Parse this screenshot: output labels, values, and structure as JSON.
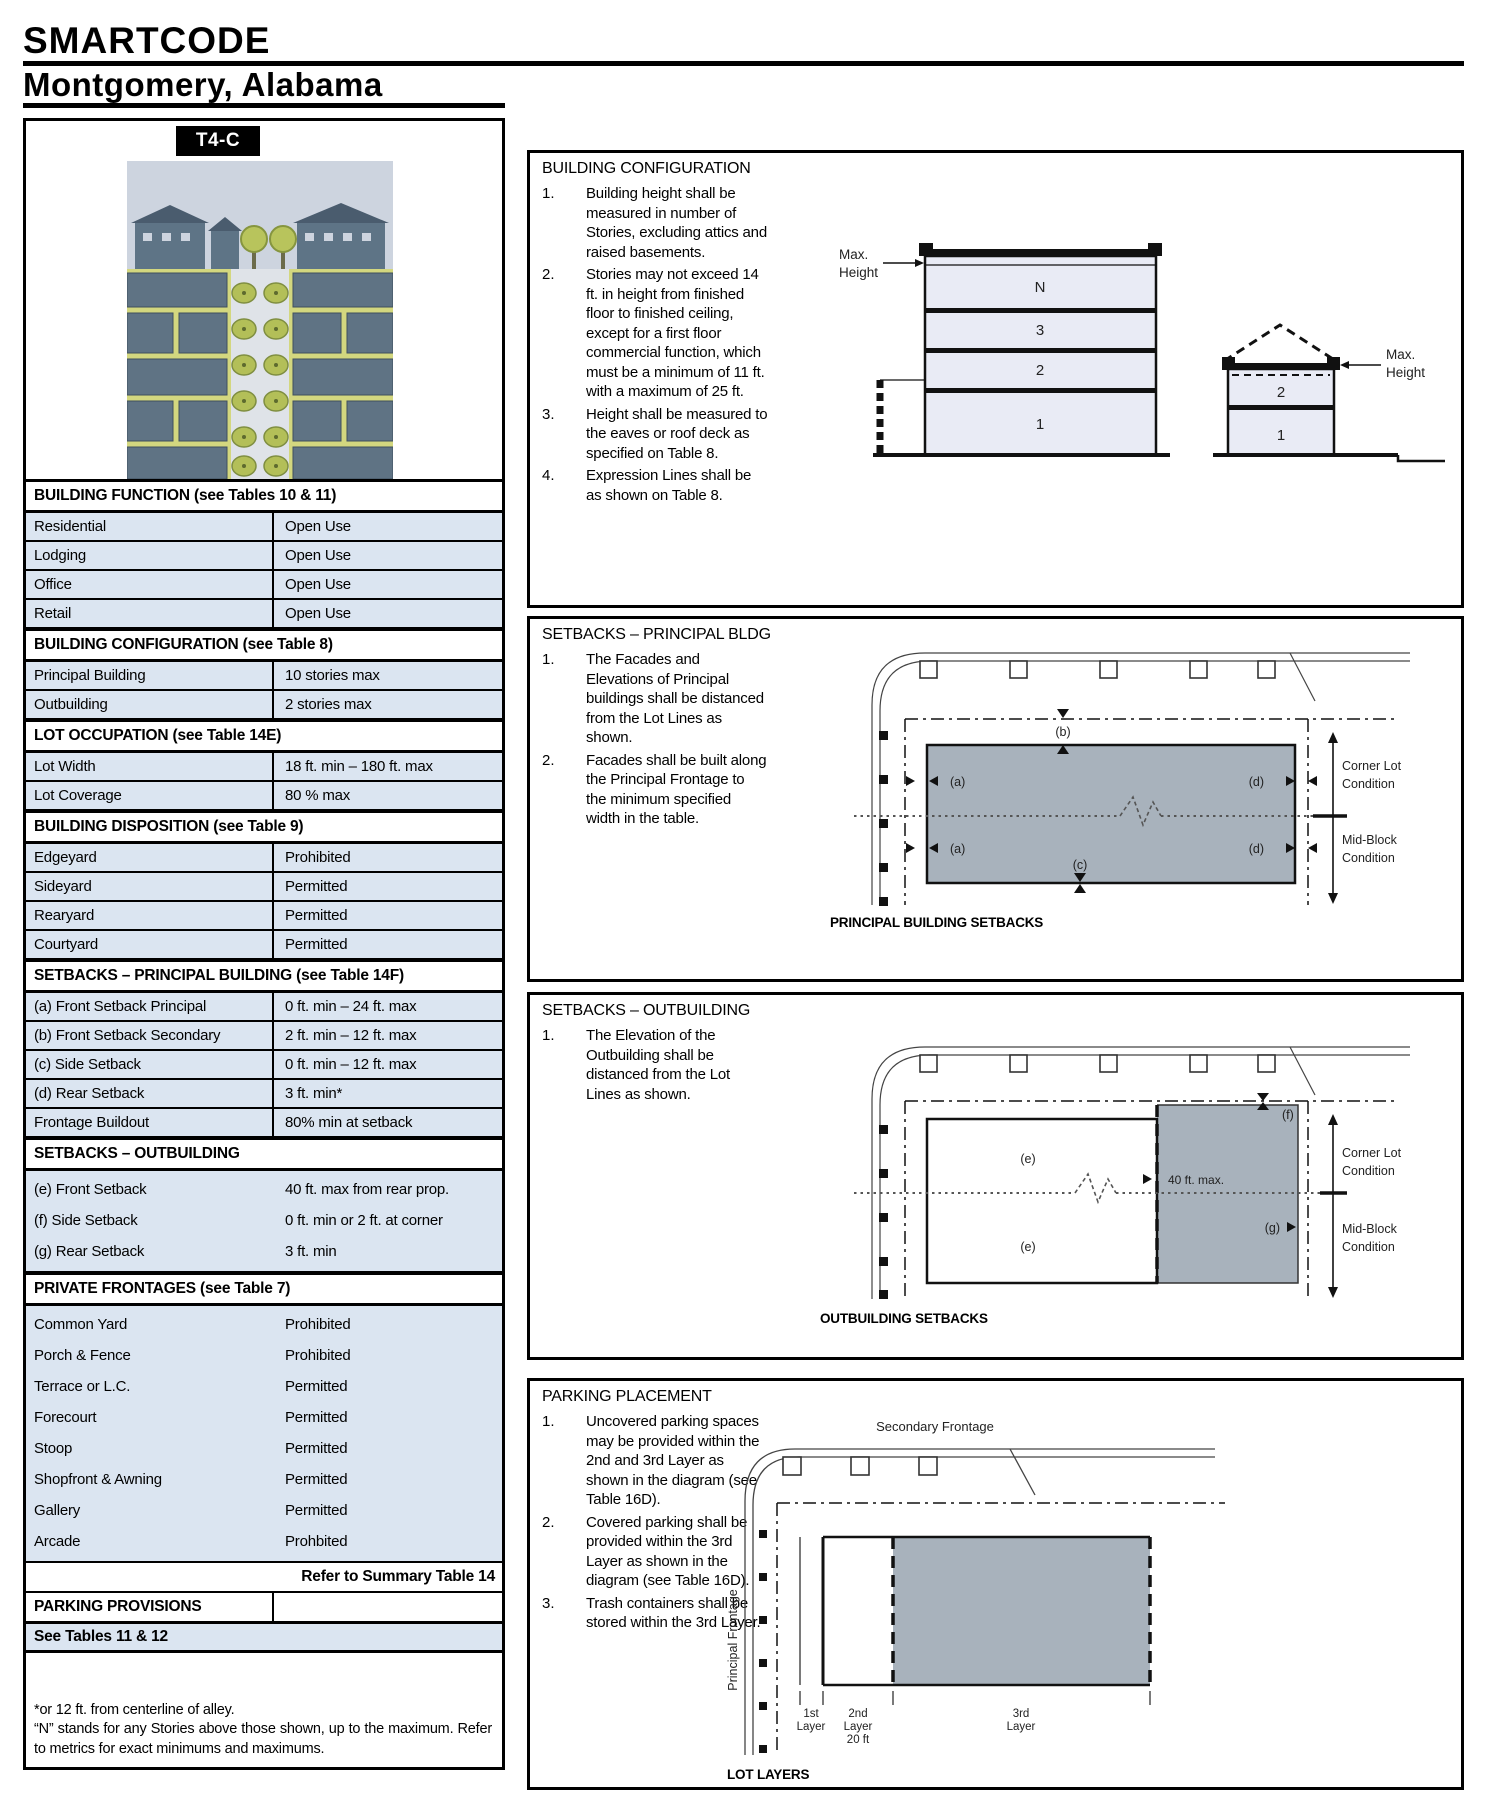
{
  "header": {
    "title": "SMARTCODE",
    "subtitle": "Montgomery, Alabama"
  },
  "zone_card": {
    "tab": "T4-C",
    "sections": [
      {
        "title": "BUILDING FUNCTION (see Tables 10 & 11)",
        "style": "bordered",
        "rows": [
          [
            "Residential",
            "Open Use"
          ],
          [
            "Lodging",
            "Open Use"
          ],
          [
            "Office",
            "Open Use"
          ],
          [
            "Retail",
            "Open Use"
          ]
        ]
      },
      {
        "title": "BUILDING CONFIGURATION (see Table 8)",
        "style": "bordered",
        "rows": [
          [
            "Principal Building",
            "10 stories max"
          ],
          [
            "Outbuilding",
            "2 stories max"
          ]
        ]
      },
      {
        "title": "LOT OCCUPATION (see Table 14E)",
        "style": "bordered",
        "rows": [
          [
            "Lot Width",
            "18 ft. min – 180 ft. max"
          ],
          [
            "Lot Coverage",
            "80 % max"
          ]
        ]
      },
      {
        "title": "BUILDING DISPOSITION (see Table 9)",
        "style": "bordered",
        "rows": [
          [
            "Edgeyard",
            "Prohibited"
          ],
          [
            "Sideyard",
            "Permitted"
          ],
          [
            "Rearyard",
            "Permitted"
          ],
          [
            "Courtyard",
            "Permitted"
          ]
        ]
      },
      {
        "title": "SETBACKS – PRINCIPAL BUILDING (see Table 14F)",
        "style": "bordered",
        "rows": [
          [
            "(a) Front Setback Principal",
            "0 ft. min – 24 ft. max"
          ],
          [
            "(b) Front Setback Secondary",
            "2 ft. min – 12 ft. max"
          ],
          [
            "(c) Side Setback",
            "0 ft. min – 12 ft. max"
          ],
          [
            "(d) Rear Setback",
            "3 ft. min*"
          ],
          [
            "Frontage Buildout",
            "80% min at setback"
          ]
        ]
      },
      {
        "title": "SETBACKS – OUTBUILDING",
        "style": "plain",
        "rows": [
          [
            "(e) Front Setback",
            "40 ft. max from rear prop."
          ],
          [
            "(f) Side Setback",
            "0 ft. min or 2 ft. at corner"
          ],
          [
            "(g) Rear Setback",
            "3 ft. min"
          ]
        ]
      },
      {
        "title": "PRIVATE FRONTAGES (see Table 7)",
        "style": "plain",
        "rows": [
          [
            "Common Yard",
            "Prohibited"
          ],
          [
            "Porch & Fence",
            "Prohibited"
          ],
          [
            "Terrace or L.C.",
            "Permitted"
          ],
          [
            "Forecourt",
            "Permitted"
          ],
          [
            "Stoop",
            "Permitted"
          ],
          [
            "Shopfront & Awning",
            "Permitted"
          ],
          [
            "Gallery",
            "Permitted"
          ],
          [
            "Arcade",
            "Prohbited"
          ]
        ]
      }
    ],
    "refer_note": "Refer to Summary Table 14",
    "parking_provisions": "PARKING PROVISIONS",
    "see_tables": "See Tables 11 & 12",
    "footnote_1": "*or 12 ft. from centerline of alley.",
    "footnote_2": "“N” stands for any Stories above those shown, up to the maximum.  Refer to metrics for exact minimums and maximums."
  },
  "panels": [
    {
      "title": "BUILDING CONFIGURATION",
      "items": [
        "Building height shall be measured in number of Stories, excluding attics and raised basements.",
        "Stories may not exceed 14 ft. in height from finished floor to finished ceiling, except for a first floor commercial function, which must be a minimum of 11 ft. with a maximum of 25 ft.",
        "Height shall be measured to the eaves or roof deck as specified on Table 8.",
        "Expression Lines shall be as shown on Table 8."
      ]
    },
    {
      "title": "SETBACKS – PRINCIPAL BLDG",
      "items": [
        "The Facades and Elevations of Principal buildings shall be distanced from the Lot Lines as shown.",
        "Facades shall be built along the Principal Frontage to the minimum specified width in the table."
      ]
    },
    {
      "title": "SETBACKS – OUTBUILDING",
      "items": [
        "The Elevation of the Outbuilding shall be distanced from the Lot Lines as shown."
      ]
    },
    {
      "title": "PARKING PLACEMENT",
      "items": [
        "Uncovered parking spaces may be provided within the 2nd and 3rd Layer as shown in the diagram (see Table 16D).",
        "Covered parking shall be provided within the 3rd Layer as shown in the diagram (see Table 16D).",
        "Trash containers shall be stored within the 3rd Layer."
      ]
    }
  ],
  "diagrams": {
    "building_config": {
      "max_label": "Max.",
      "height_label": "Height",
      "floors_principal": [
        "N",
        "3",
        "2",
        "1"
      ],
      "floors_outbuilding": [
        "2",
        "1"
      ]
    },
    "principal_setbacks": {
      "a": "(a)",
      "b": "(b)",
      "c": "(c)",
      "d": "(d)",
      "corner_lot_1": "Corner Lot",
      "corner_lot_2": "Condition",
      "mid_block_1": "Mid-Block",
      "mid_block_2": "Condition",
      "caption": "PRINCIPAL BUILDING SETBACKS"
    },
    "outbuilding_setbacks": {
      "e": "(e)",
      "f": "(f)",
      "g": "(g)",
      "max_40": "40 ft. max.",
      "corner_lot_1": "Corner Lot",
      "corner_lot_2": "Condition",
      "mid_block_1": "Mid-Block",
      "mid_block_2": "Condition",
      "caption": "OUTBUILDING SETBACKS"
    },
    "parking": {
      "secondary_frontage": "Secondary Frontage",
      "principal_frontage": "Principal Frontage",
      "layer1_1": "1st",
      "layer1_2": "Layer",
      "layer2_1": "2nd",
      "layer2_2": "Layer",
      "layer2_3": "20 ft",
      "layer3_1": "3rd",
      "layer3_2": "Layer",
      "caption": "LOT LAYERS"
    },
    "colors": {
      "row_shade": "#dbe5f1",
      "building_fill": "#a8b2bc",
      "floor_fill": "#e9ebf5"
    }
  }
}
